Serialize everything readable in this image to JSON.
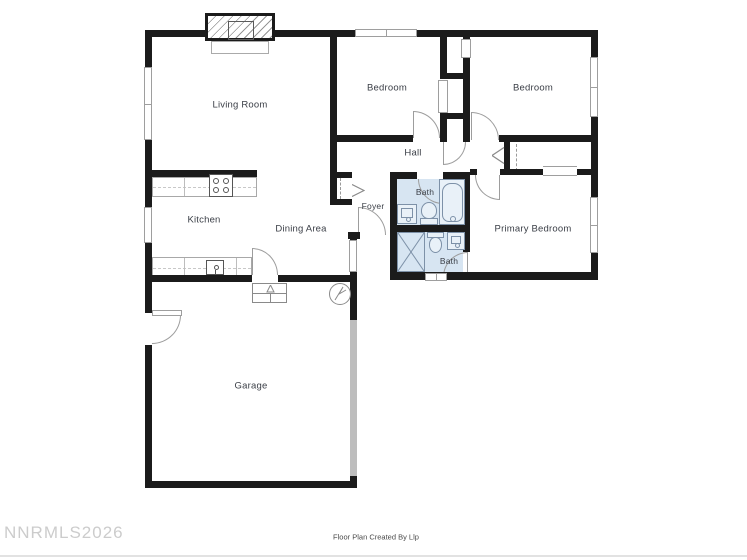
{
  "plan": {
    "watermark": "NNRMLS2026",
    "credit": "Floor Plan Created By Llp"
  },
  "colors": {
    "wall": "#1b1b1b",
    "bath_fill": "#d7e5f2",
    "fixture_stroke": "#7d91a8",
    "window_stroke": "#9e9e9e",
    "door_arc": "#9d9d9d",
    "label_text": "#3a3e46",
    "watermark_text": "#cccccc"
  },
  "rooms": {
    "living_room": {
      "label": "Living Room"
    },
    "bedroom_left": {
      "label": "Bedroom"
    },
    "bedroom_right": {
      "label": "Bedroom"
    },
    "hall": {
      "label": "Hall"
    },
    "kitchen": {
      "label": "Kitchen"
    },
    "dining_area": {
      "label": "Dining Area"
    },
    "foyer": {
      "label": "Foyer"
    },
    "bath_top": {
      "label": "Bath"
    },
    "bath_bottom": {
      "label": "Bath"
    },
    "primary_bedroom": {
      "label": "Primary Bedroom"
    },
    "garage": {
      "label": "Garage"
    }
  },
  "fixtures": {
    "symbols": [
      "fireplace",
      "stove",
      "kitchen-sink",
      "bathtub",
      "toilet",
      "vanity-sink",
      "shower",
      "furnace",
      "water-heater",
      "closet-bifold",
      "sliding-door",
      "door-swing",
      "window"
    ]
  }
}
